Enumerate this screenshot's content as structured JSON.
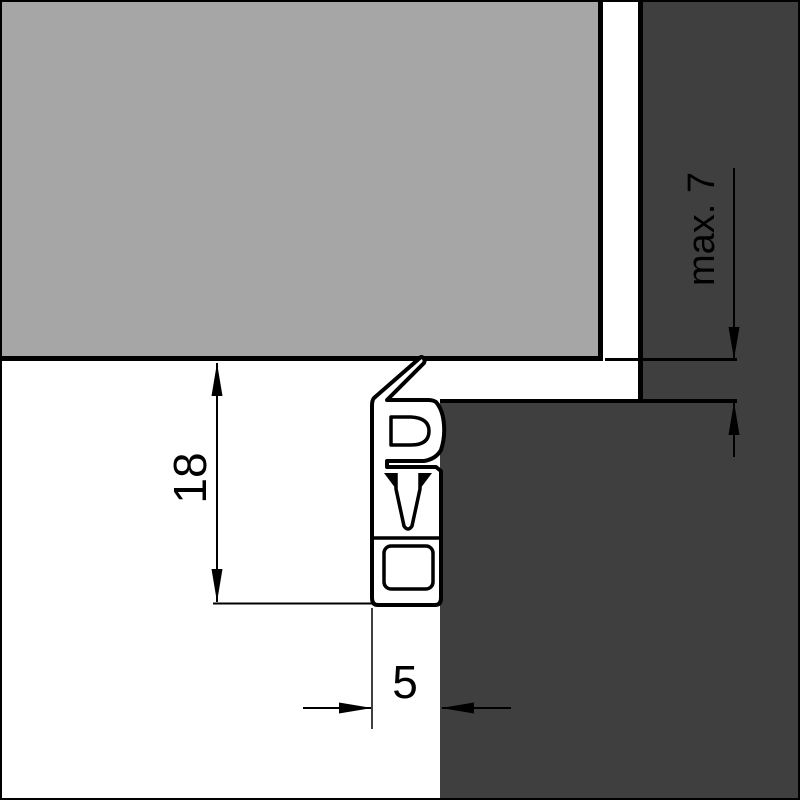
{
  "labels": {
    "dim_height": "18",
    "dim_width": "5",
    "dim_clearance": "max. 7"
  },
  "colors": {
    "background": "#ffffff",
    "sash_gray": "#a6a6a6",
    "frame_gray": "#3f3f3f",
    "line_black": "#000000"
  }
}
